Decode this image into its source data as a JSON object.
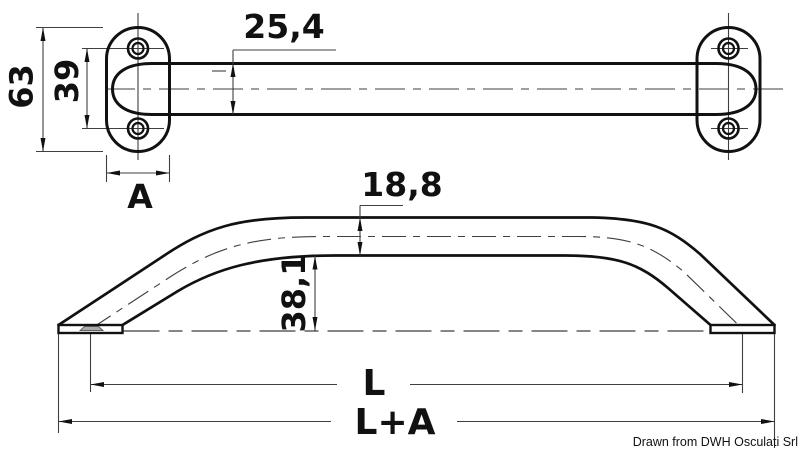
{
  "drawing": {
    "credit": "Drawn from DWH Osculati Srl",
    "top_view": {
      "dim_plate_height": "63",
      "dim_hole_spacing": "39",
      "dim_plate_width": "A",
      "dim_tube_diameter": "25,4"
    },
    "side_view": {
      "dim_tube_height": "18,8",
      "dim_grip_clearance": "38,1",
      "dim_length_centers": "L",
      "dim_length_overall": "L+A"
    },
    "colors": {
      "outline": "#111111",
      "thin_line": "#3f3f3f",
      "background": "#ffffff"
    }
  }
}
